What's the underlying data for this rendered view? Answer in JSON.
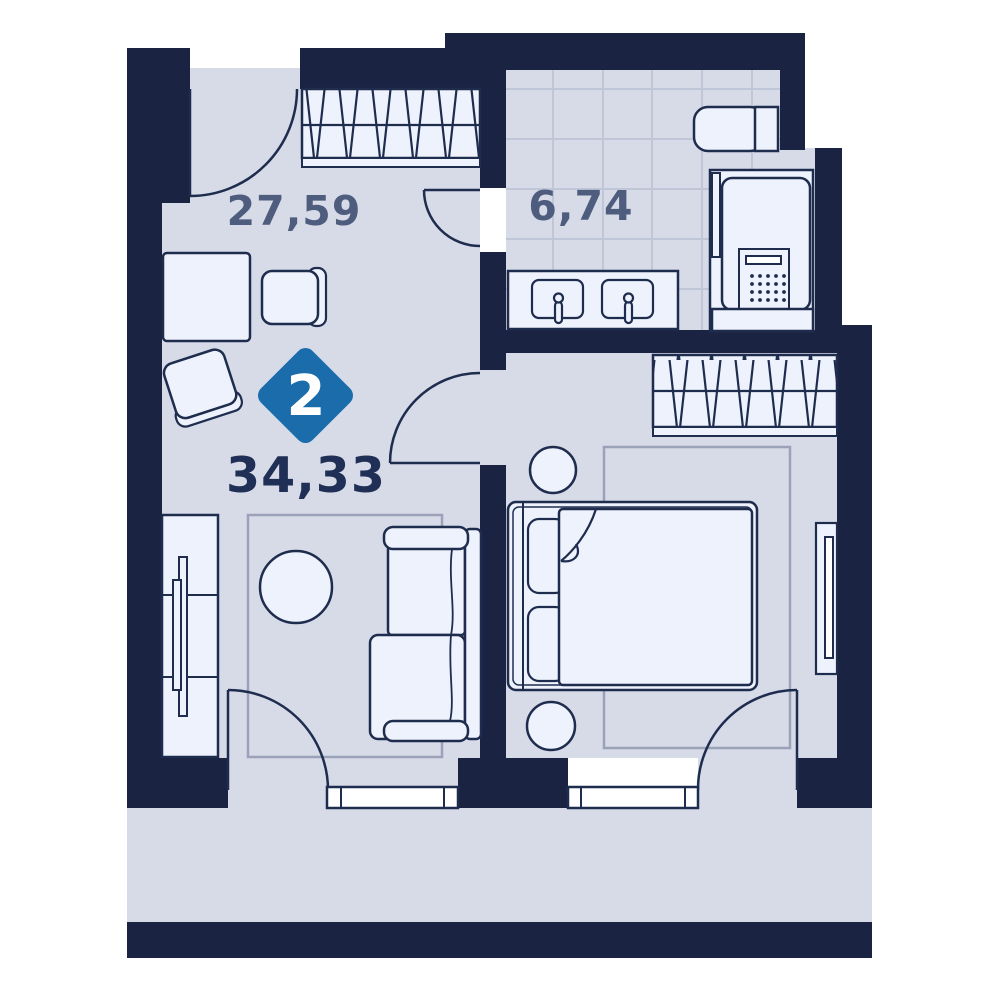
{
  "floor_plan": {
    "kind": "apartment-floor-plan",
    "badge": {
      "rooms_count": "2",
      "color": "#1a6cab"
    },
    "total_area": "34,33",
    "rooms": [
      {
        "id": "living-room",
        "area": "27,59"
      },
      {
        "id": "bathroom",
        "area": "6,74"
      }
    ],
    "colors": {
      "wall": "#1a2342",
      "floor": "#d7dbe8",
      "fixture_fill": "#eef2fc",
      "outline": "#1e2c4e",
      "tile_line": "#bfc6d8",
      "rug_line": "#9aa2b8",
      "window_fill": "#ffffff",
      "badge_blue": "#1a6cab",
      "area_text": "#4e5c7e",
      "total_text": "#202f55"
    }
  }
}
